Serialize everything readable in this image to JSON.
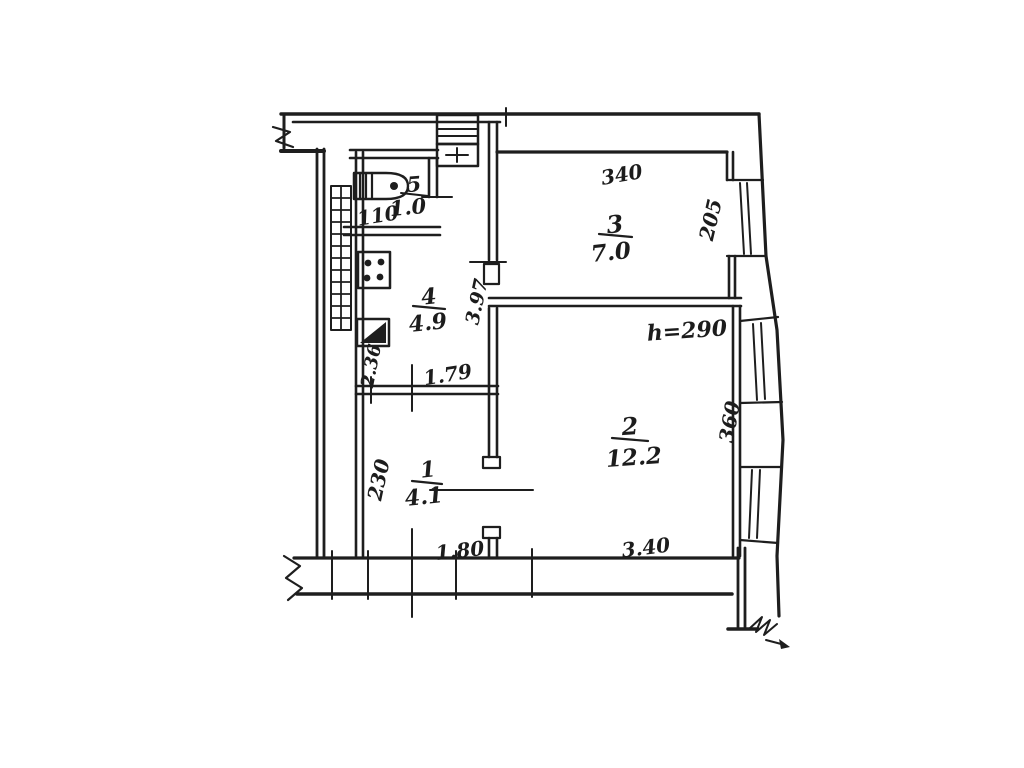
{
  "floor_plan": {
    "background_color": "#ffffff",
    "ink_color": "#1e1e1e",
    "rooms": [
      {
        "number": "1",
        "area": "4.1"
      },
      {
        "number": "2",
        "area": "12.2"
      },
      {
        "number": "3",
        "area": "7.0"
      },
      {
        "number": "4",
        "area": "4.9"
      },
      {
        "number": "5",
        "area": "1.0"
      }
    ],
    "dimensions": {
      "room3_top": "340",
      "room3_window": "205",
      "ceiling_height": "h=290",
      "room2_window": "360",
      "room2_bottom": "3.40",
      "partition_wall": "3.97",
      "kitchen_bottom": "1.79",
      "kitchen_side": "2.36",
      "toilet_bottom": "110",
      "hall_side": "230",
      "hall_bottom": "1.80"
    },
    "symbols": [
      "wc-toilet",
      "gas-stove",
      "kitchen-sink",
      "ventilation-shaft",
      "radiator-hatch",
      "window",
      "wall-break",
      "north-break-arrow"
    ]
  }
}
